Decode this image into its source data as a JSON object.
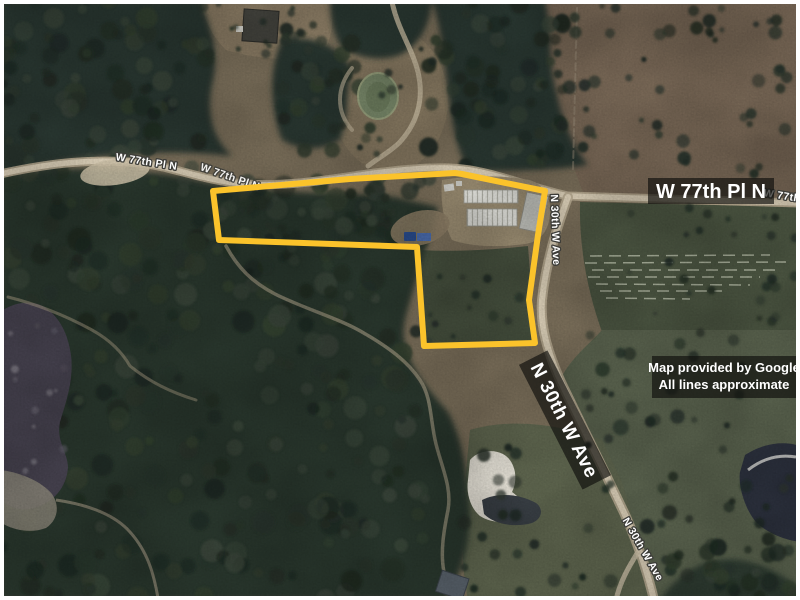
{
  "map": {
    "parcel": {
      "boundary_path": "M 213 191 L 350 179 L 455 173 L 462 174 L 545 191 L 538 235 L 529 300 L 535 343 L 424 346 L 417 247 L 219 240 Z",
      "stroke_color": "#FBC32B"
    },
    "labels": {
      "road_major": "W 77th Pl N",
      "road_secondary": "N 30th W Ave",
      "road_small_left": "W 77th Pl N",
      "road_small_mid": "W 77th Pl N",
      "road_small_right": "W 77th Pl N",
      "road_small_vertical": "N 30th W Ave",
      "road_small_diagonal": "N 30th W Ave"
    },
    "attribution": {
      "line1": "Map provided by Google",
      "line2": "All lines approximate"
    },
    "colors": {
      "band_bg": "rgba(16,16,14,0.68)",
      "label_fill": "#ffffff"
    }
  }
}
